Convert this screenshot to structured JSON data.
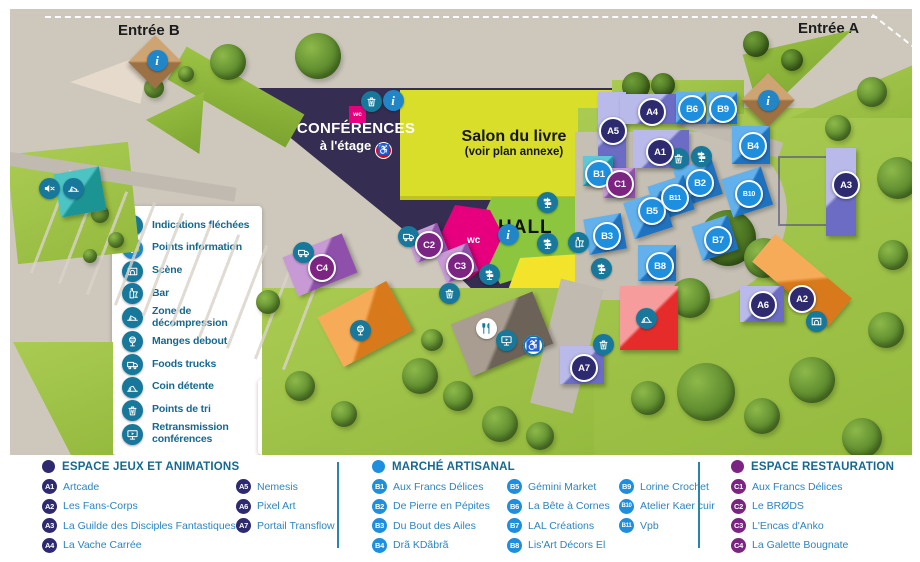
{
  "map": {
    "entrance_b": "Entrée B",
    "entrance_a": "Entrée A",
    "conference_title": "CONFÉRENCES",
    "conference_subtitle": "à l'étage",
    "salon_title": "Salon du livre",
    "salon_subtitle": "(voir plan annexe)",
    "hall_label": "HALL",
    "librairies_label": "Librairies",
    "wc_label": "wc"
  },
  "legend": {
    "items": [
      {
        "icon": "signpost-icon",
        "label": "Indications fléchées"
      },
      {
        "icon": "info-icon",
        "label": "Points information"
      },
      {
        "icon": "stage-icon",
        "label": "Scène"
      },
      {
        "icon": "bar-icon",
        "label": "Bar"
      },
      {
        "icon": "deckchair-icon",
        "label": "Zone de décompression"
      },
      {
        "icon": "standing-table-icon",
        "label": "Manges debout"
      },
      {
        "icon": "food-truck-icon",
        "label": "Foods trucks"
      },
      {
        "icon": "lounge-icon",
        "label": "Coin détente"
      },
      {
        "icon": "recycle-icon",
        "label": "Points de tri"
      },
      {
        "icon": "screen-icon",
        "label": "Retransmission conférences"
      }
    ]
  },
  "notes": {
    "items": [
      {
        "icon": "mute-icon",
        "label": "Merci de ne pas faire de bruit dans cette zone"
      },
      {
        "icon": "no-access-icon",
        "label": "Zone non accessible"
      },
      {
        "icon": "accessible-icon",
        "label": "Zone accessible pour les conférences"
      }
    ]
  },
  "directory": {
    "sections": [
      {
        "id": "animations",
        "title": "ESPACE JEUX ET ANIMATIONS",
        "color": "#2e2a70",
        "items": [
          {
            "code": "A1",
            "name": "Artcade"
          },
          {
            "code": "A2",
            "name": "Les Fans-Corps"
          },
          {
            "code": "A3",
            "name": "La Guilde des Disciples Fantastiques"
          },
          {
            "code": "A4",
            "name": "La Vache Carrée"
          },
          {
            "code": "A5",
            "name": "Nemesis"
          },
          {
            "code": "A6",
            "name": "Pixel Art"
          },
          {
            "code": "A7",
            "name": "Portail Transflow"
          }
        ]
      },
      {
        "id": "marche",
        "title": "MARCHÉ ARTISANAL",
        "color": "#1e8ede",
        "items": [
          {
            "code": "B1",
            "name": "Aux Francs Délices"
          },
          {
            "code": "B2",
            "name": "De Pierre en Pépites"
          },
          {
            "code": "B3",
            "name": "Du Bout des Ailes"
          },
          {
            "code": "B4",
            "name": "Drã KDãbrã"
          },
          {
            "code": "B5",
            "name": "Gémini Market"
          },
          {
            "code": "B6",
            "name": "La Bête à Cornes"
          },
          {
            "code": "B7",
            "name": "LAL Créations"
          },
          {
            "code": "B8",
            "name": "Lis'Art Décors El"
          },
          {
            "code": "B9",
            "name": "Lorine Crochet"
          },
          {
            "code": "B10",
            "name": "Atelier Kaer cuir"
          },
          {
            "code": "B11",
            "name": "Vpb"
          }
        ]
      },
      {
        "id": "restauration",
        "title": "ESPACE RESTAURATION",
        "color": "#7b2482",
        "items": [
          {
            "code": "C1",
            "name": "Aux Francs Délices"
          },
          {
            "code": "C2",
            "name": "Le BRØDS"
          },
          {
            "code": "C3",
            "name": "L'Encas d'Anko"
          },
          {
            "code": "C4",
            "name": "La Galette Bougnate"
          }
        ]
      }
    ]
  },
  "colors": {
    "accent_text": "#17688f",
    "item_text": "#2d84c0",
    "teal_icon": "#17789b",
    "blue_icon": "#2186c8",
    "red_icon": "#e30613"
  }
}
